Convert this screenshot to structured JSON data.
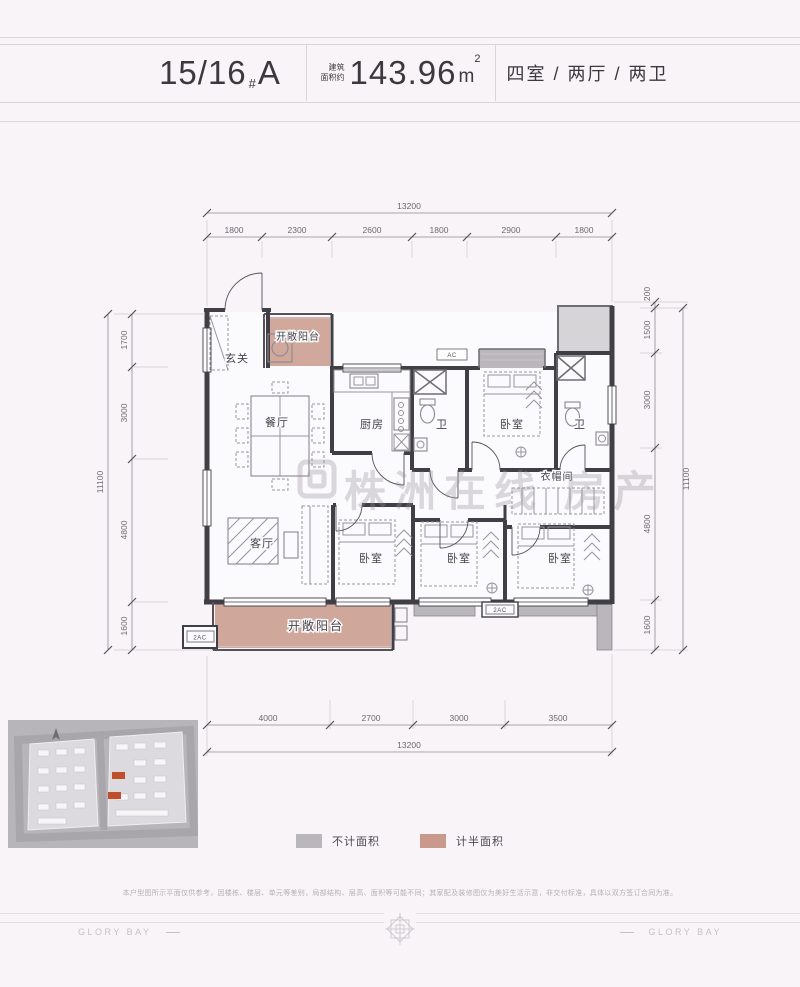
{
  "header": {
    "unit": "15/16",
    "unit_sep": "#",
    "unit_type": "A",
    "area_label_1": "建筑",
    "area_label_2": "面积约",
    "area_value": "143.96",
    "area_unit": "m",
    "area_sup": "2",
    "layout": "四室 / 两厅 / 两卫"
  },
  "plan": {
    "dims": {
      "top_total": "13200",
      "top_segments": [
        "1800",
        "2300",
        "2600",
        "1800",
        "2900",
        "1800"
      ],
      "bottom_total": "13200",
      "bottom_segments": [
        "4000",
        "2700",
        "3000",
        "3500"
      ],
      "left_total": "11100",
      "left_segments": [
        "1700",
        "3000",
        "4800",
        "1600"
      ],
      "right_total": "11100",
      "right_segments": [
        "200",
        "1500",
        "3000",
        "4800",
        "1600"
      ]
    },
    "rooms": {
      "entry": "玄关",
      "balcony_top": "开敞阳台",
      "dining": "餐厅",
      "kitchen": "厨房",
      "bath1": "卫",
      "bedroom_top": "卧室",
      "bath2": "卫",
      "cloakroom": "衣帽间",
      "living": "客厅",
      "bedroom2": "卧室",
      "bedroom3": "卧室",
      "bedroom4": "卧室",
      "balcony_bottom": "开敞阳台"
    },
    "ac": {
      "top": "AC",
      "left": "2AC",
      "bottom": "2AC"
    },
    "watermark": "株洲在线 房产"
  },
  "legend": {
    "items": [
      {
        "label": "不计面积",
        "color": "#b9b6bc"
      },
      {
        "label": "计半面积",
        "color": "#c99a8b"
      }
    ]
  },
  "disclaimer": "本户型图所示平面仅供参考，因楼栋、楼层、单元等差别，局部结构、层高、面积等可能不同；其家配及装修图仅为美好生活示意，非交付标准，具体以双方签订合同为准。",
  "footer": {
    "brand_left": "GLORY BAY",
    "brand_right": "GLORY BAY"
  }
}
